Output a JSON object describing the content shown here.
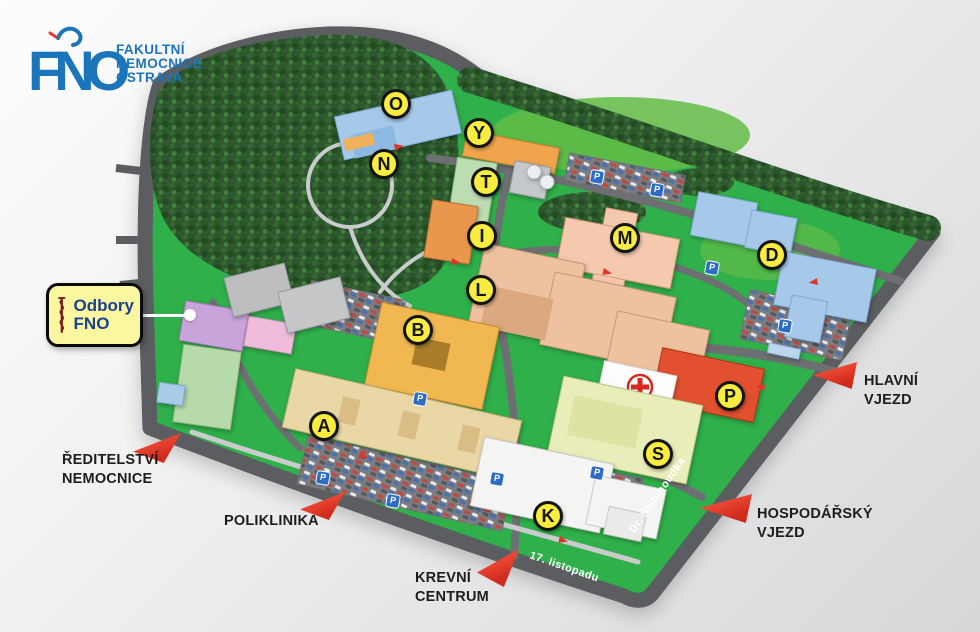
{
  "logo": {
    "abbr": "FNO",
    "lines": [
      "FAKULTNÍ",
      "NEMOCNICE",
      "OSTRAVA"
    ],
    "color": "#1b75bc"
  },
  "callout": {
    "org_line1": "Odbory",
    "org_line2": "FNO",
    "icon": "rod-of-asclepius-icon"
  },
  "building_markers": [
    {
      "letter": "O"
    },
    {
      "letter": "Y"
    },
    {
      "letter": "N"
    },
    {
      "letter": "T"
    },
    {
      "letter": "I"
    },
    {
      "letter": "M"
    },
    {
      "letter": "D"
    },
    {
      "letter": "L"
    },
    {
      "letter": "B"
    },
    {
      "letter": "P"
    },
    {
      "letter": "A"
    },
    {
      "letter": "S"
    },
    {
      "letter": "K"
    }
  ],
  "entrances": [
    {
      "id": "reditelstvi-nemocnice",
      "lines": [
        "ŘEDITELSTVÍ",
        "NEMOCNICE"
      ]
    },
    {
      "id": "poliklinika",
      "lines": [
        "POLIKLINIKA"
      ]
    },
    {
      "id": "krevni-centrum",
      "lines": [
        "KREVNÍ",
        "CENTRUM"
      ]
    },
    {
      "id": "hlavni-vjezd",
      "lines": [
        "HLAVNÍ",
        "VJEZD"
      ]
    },
    {
      "id": "hospodarsky-vjezd",
      "lines": [
        "HOSPODÁŘSKÝ",
        "VJEZD"
      ]
    }
  ],
  "streets": [
    {
      "name": "17. listopadu"
    },
    {
      "name": "Dr. Slabihoudka"
    }
  ],
  "parking_sign_glyph": "P",
  "colors": {
    "grass": "#2fb04a",
    "road": "#5b5d60",
    "marker_fill": "#f7ec3f",
    "entrance_arrow": "#e8352b",
    "logo_blue": "#1b75bc",
    "callout_bg": "#fbf6a0",
    "callout_text": "#1c418f",
    "emergency_building": "#e2502f",
    "helipad_cross": "#d6281e"
  }
}
